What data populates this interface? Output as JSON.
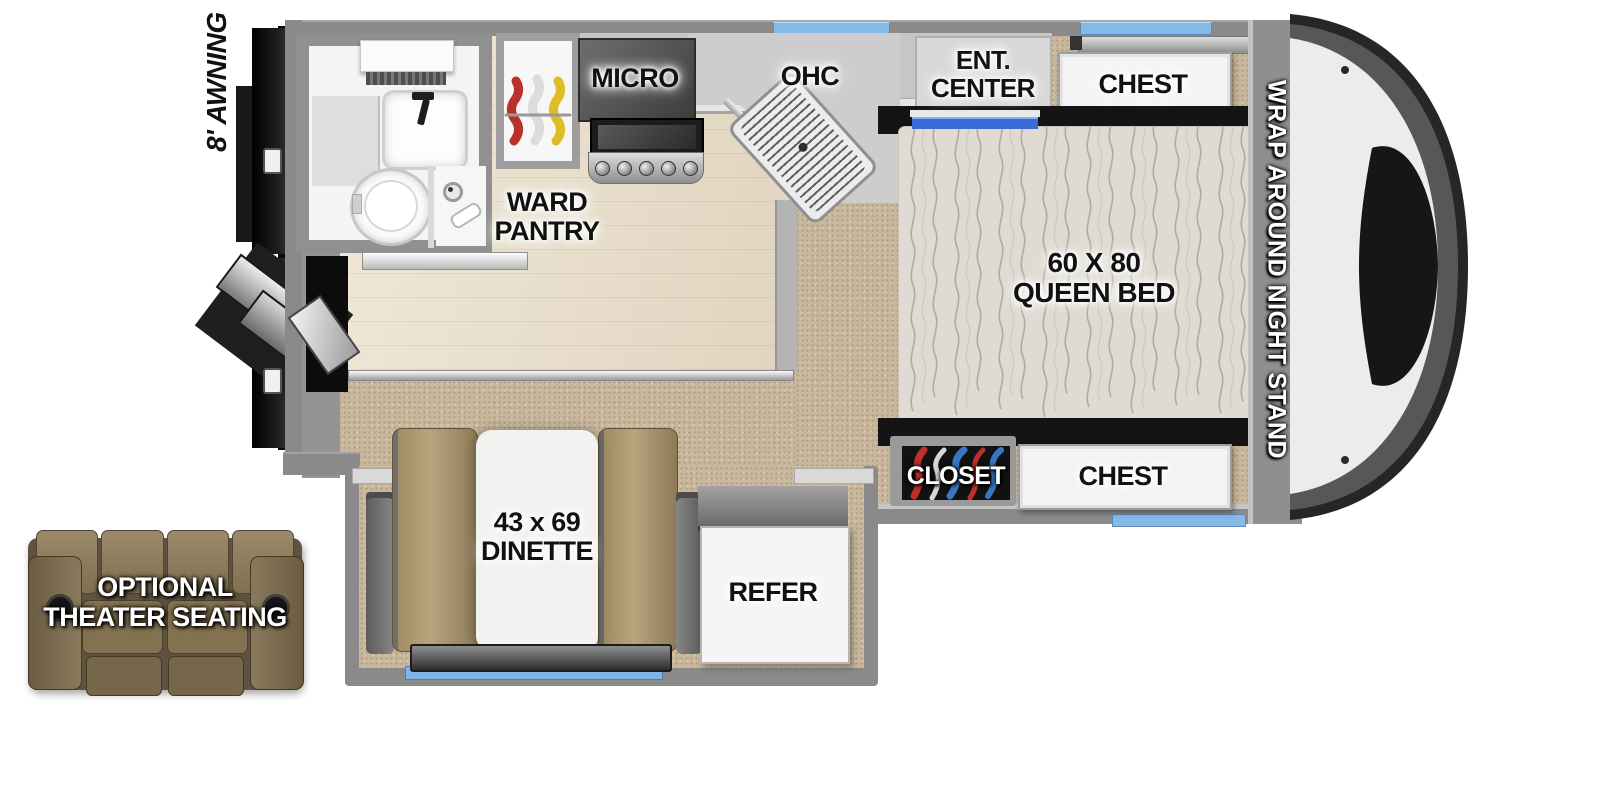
{
  "floorplan": {
    "awning_label": "8' AWNING",
    "wardrobe": {
      "label_line1": "WARD",
      "label_line2": "PANTRY"
    },
    "kitchen": {
      "micro_label": "MICRO",
      "ohc_label": "OHC"
    },
    "entertainment": {
      "label_line1": "ENT.",
      "label_line2": "CENTER"
    },
    "bedroom": {
      "chest_top_label": "CHEST",
      "bed_label_line1": "60 X 80",
      "bed_label_line2": "QUEEN BED",
      "nightstand_label": "WRAP AROUND NIGHT STAND",
      "closet_label": "CLOSET",
      "chest_bottom_label": "CHEST"
    },
    "dinette": {
      "label_line1": "43 x 69",
      "label_line2": "DINETTE"
    },
    "refrigerator": {
      "label": "REFER"
    },
    "theater_seating": {
      "label_line1": "OPTIONAL",
      "label_line2": "THEATER SEATING"
    },
    "colors": {
      "window_blue": "#85b9e8",
      "tv_accent_blue": "#3a6bd6",
      "wall_gray": "#8a8a8a",
      "carpet_tan": "#c8b79d",
      "wood_floor": "#e8decd",
      "mattress": "#dfdad2",
      "bench_tan": "#a5916b",
      "sofa_brown": "#7c6c50",
      "hanger_red": "#b8322b",
      "hanger_yellow": "#ddbf25",
      "label_black": "#111111",
      "label_white": "#ffffff"
    }
  }
}
